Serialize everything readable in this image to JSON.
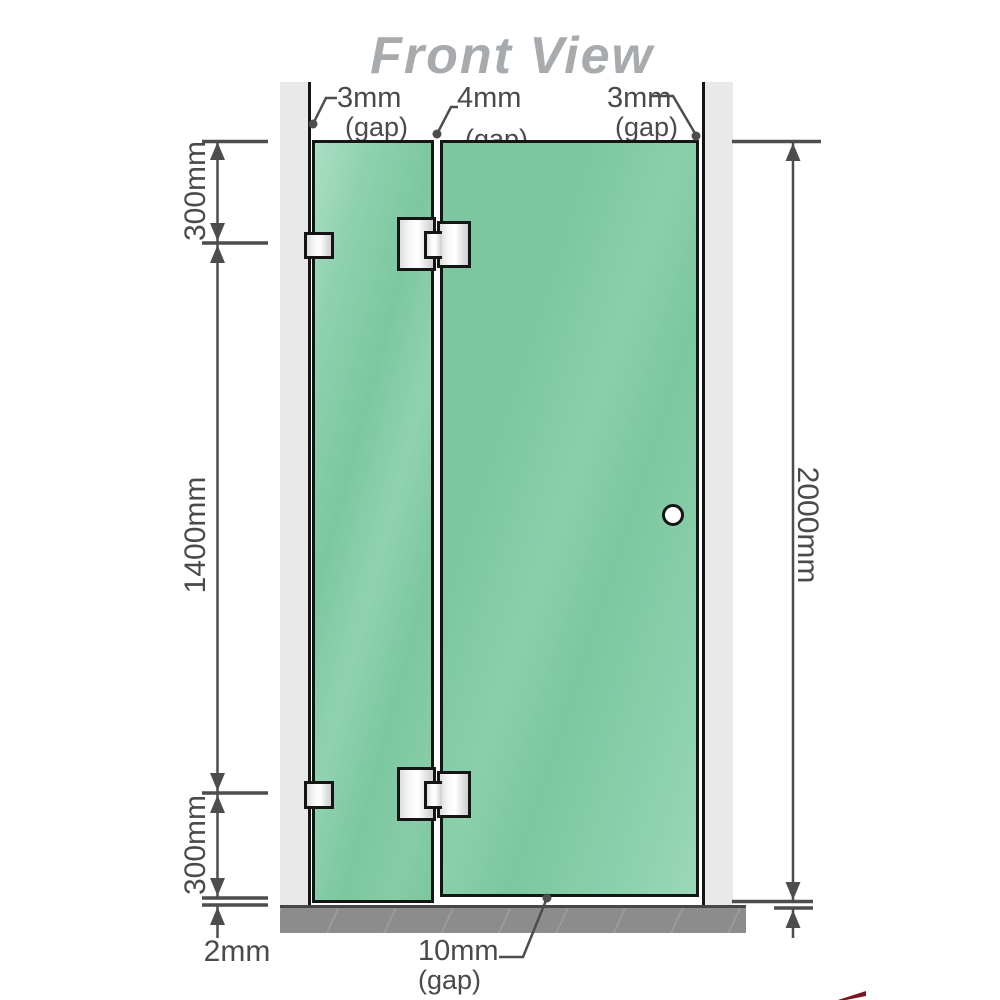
{
  "title": "Front View",
  "labels": {
    "gap_left": {
      "value": "3mm",
      "suffix": "(gap)"
    },
    "gap_middle": {
      "value": "4mm",
      "suffix": "(gap)"
    },
    "gap_right": {
      "value": "3mm",
      "suffix": "(gap)"
    },
    "gap_bottom": {
      "value": "10mm",
      "suffix": "(gap)"
    },
    "floor_gap": "2mm"
  },
  "dimensions": {
    "top_segment": "300mm",
    "middle_segment": "1400mm",
    "bottom_segment": "300mm",
    "total_height": "2000mm"
  },
  "colors": {
    "glass": "#7cc7a0",
    "wall": "#e9e9e9",
    "floor": "#8c8c8c",
    "edge": "#151515",
    "line": "#4d4d4d",
    "text": "#4a4a4a",
    "title_color": "#a8abad",
    "logo_red": "#7a1522"
  }
}
